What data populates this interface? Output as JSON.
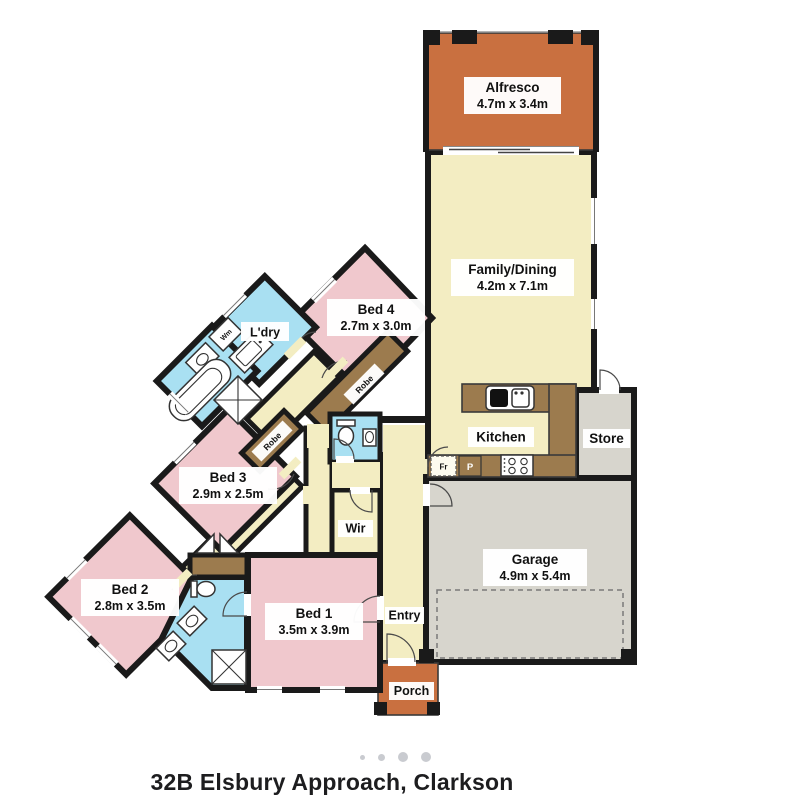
{
  "caption": "32B Elsbury Approach, Clarkson",
  "carousel": {
    "dot_count": 4,
    "dot_sizes": [
      "small",
      "medium",
      "large",
      "large"
    ]
  },
  "colors": {
    "walls": "#1a1a1a",
    "living": "#F3EDC2",
    "bedroom": "#F0C8CD",
    "wet": "#A9E0F2",
    "outdoor": "#C97040",
    "garage": "#D7D5CD",
    "joinery": "#9C7B4E",
    "label_bg": "#FFFFFF",
    "text": "#111111",
    "dots": "#C9CBD0"
  },
  "floorplan": {
    "rooms": [
      {
        "id": "alfresco",
        "name": "Alfresco",
        "dims": "4.7m x 3.4m"
      },
      {
        "id": "family_dining",
        "name": "Family/Dining",
        "dims": "4.2m x 7.1m"
      },
      {
        "id": "kitchen",
        "name": "Kitchen"
      },
      {
        "id": "store",
        "name": "Store"
      },
      {
        "id": "garage",
        "name": "Garage",
        "dims": "4.9m x 5.4m"
      },
      {
        "id": "entry",
        "name": "Entry"
      },
      {
        "id": "porch",
        "name": "Porch"
      },
      {
        "id": "wir",
        "name": "Wir"
      },
      {
        "id": "bed1",
        "name": "Bed 1",
        "dims": "3.5m x 3.9m"
      },
      {
        "id": "bed2",
        "name": "Bed 2",
        "dims": "2.8m x 3.5m"
      },
      {
        "id": "bed3",
        "name": "Bed 3",
        "dims": "2.9m x 2.5m"
      },
      {
        "id": "bed4",
        "name": "Bed 4",
        "dims": "2.7m x 3.0m"
      },
      {
        "id": "laundry",
        "name": "L'dry"
      }
    ],
    "fixtures": {
      "washing_machine": "Wm",
      "fridge": "Fr",
      "pantry": "P",
      "robe_bed3": "Robe",
      "robe_bed4": "Robe"
    }
  }
}
